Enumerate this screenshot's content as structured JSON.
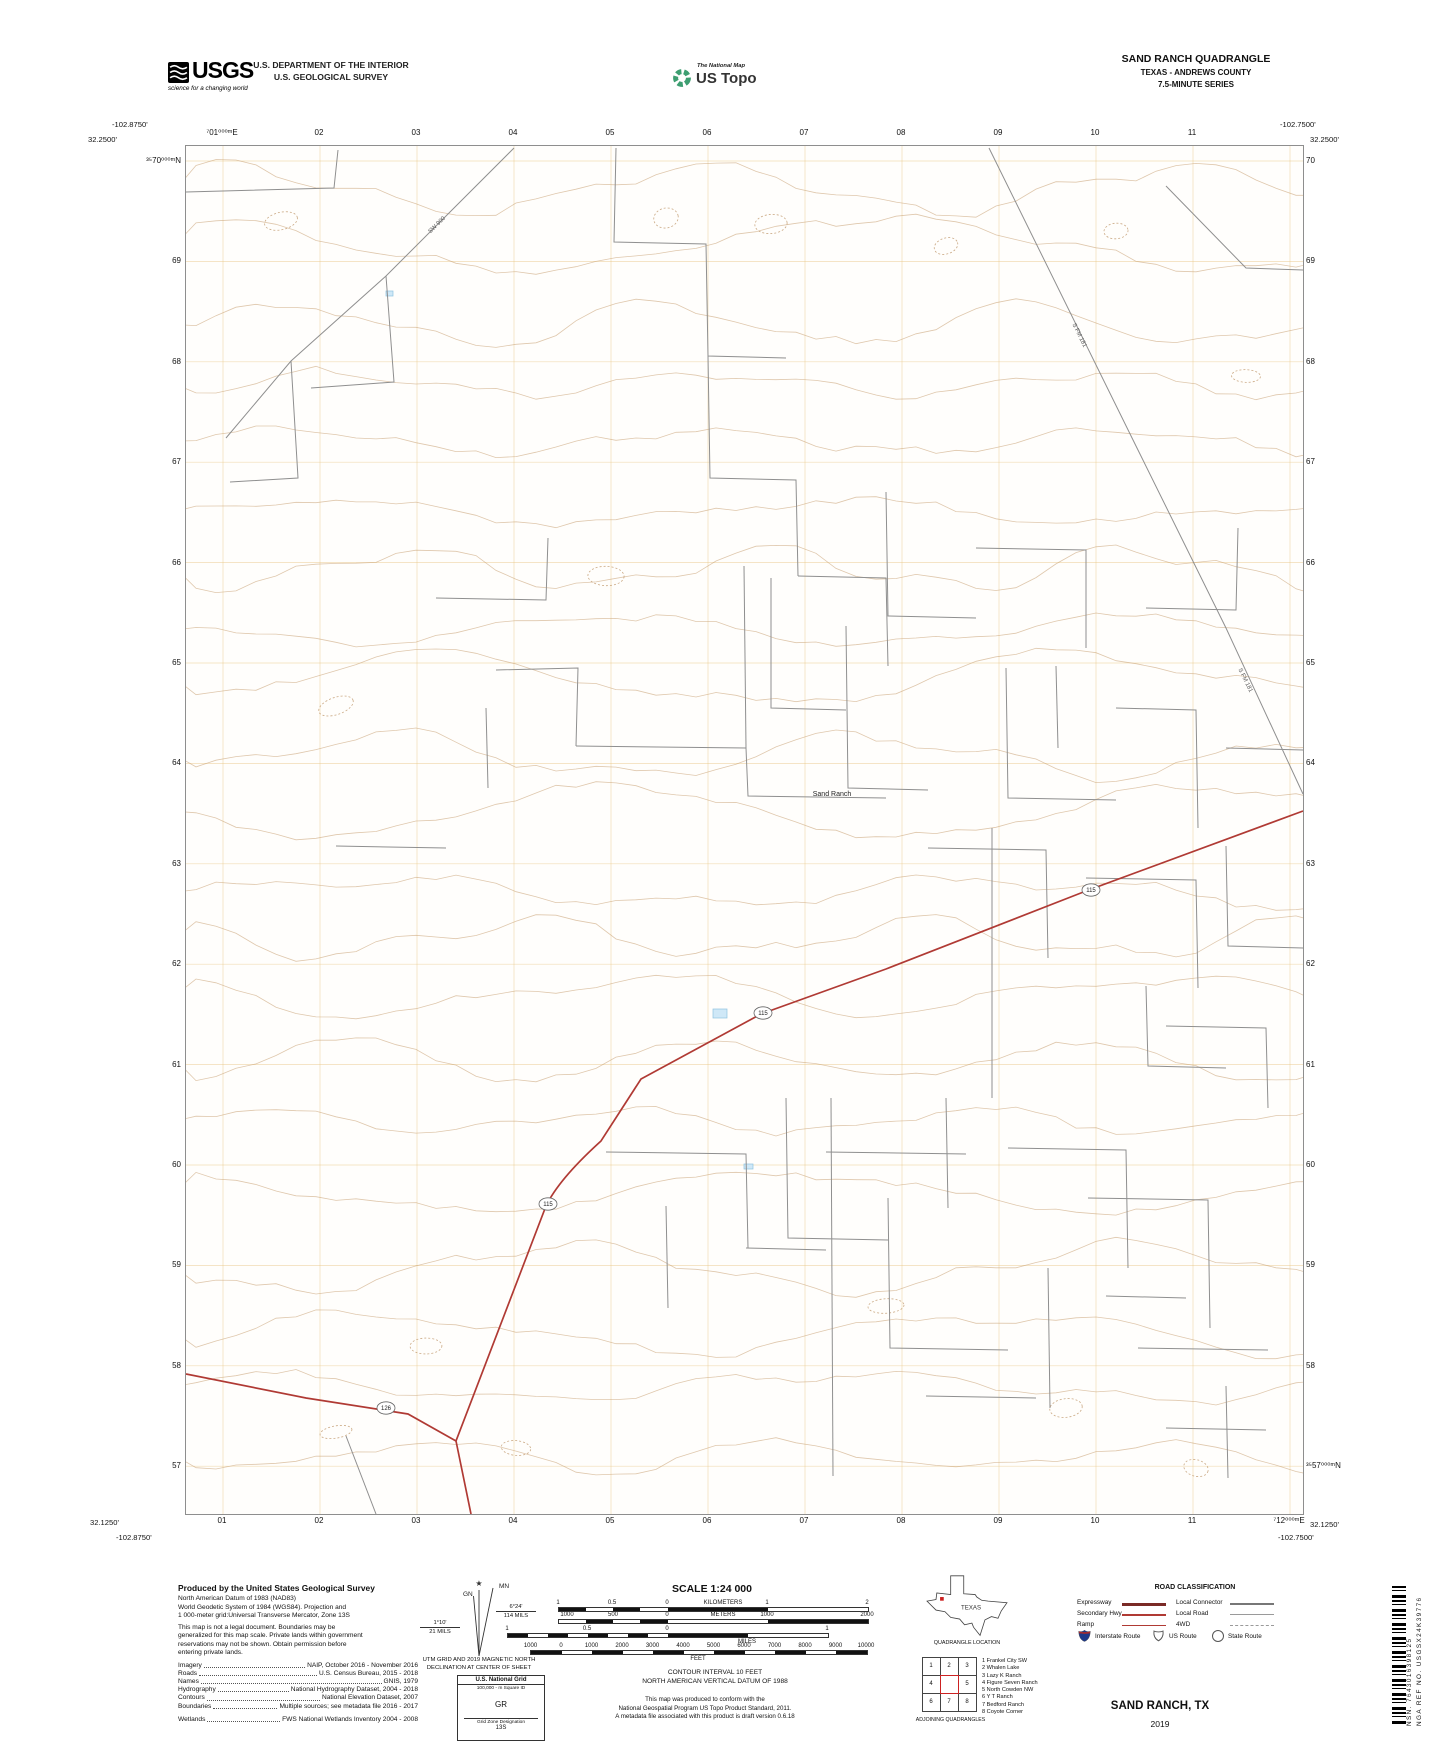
{
  "header": {
    "usgs_logo_text": "USGS",
    "usgs_tagline": "science for a changing world",
    "agency_line1": "U.S. DEPARTMENT OF THE INTERIOR",
    "agency_line2": "U.S. GEOLOGICAL SURVEY",
    "natmap_label": "The National Map",
    "ustopo_label": "US Topo",
    "quad_title": "SAND RANCH QUADRANGLE",
    "quad_subtitle": "TEXAS - ANDREWS COUNTY",
    "quad_series": "7.5-MINUTE SERIES"
  },
  "map": {
    "corners": {
      "top_left_lon": "-102.8750'",
      "top_left_lat": "32.2500'",
      "top_right_lon": "-102.7500'",
      "top_right_lat": "32.2500'",
      "bottom_left_lat": "32.1250'",
      "bottom_left_lon": "-102.8750'",
      "bottom_right_lon": "-102.7500'",
      "bottom_right_lat": "32.1250'"
    },
    "grid_top": [
      "⁷01⁰⁰⁰ᵐE",
      "02",
      "03",
      "04",
      "05",
      "06",
      "07",
      "08",
      "09",
      "10",
      "11"
    ],
    "grid_bottom": [
      "01",
      "02",
      "03",
      "04",
      "05",
      "06",
      "07",
      "08",
      "09",
      "10",
      "11",
      "⁷12⁰⁰⁰ᵐE"
    ],
    "grid_left": [
      "³⁵70⁰⁰⁰ᵐN",
      "69",
      "68",
      "67",
      "66",
      "65",
      "64",
      "63",
      "62",
      "61",
      "60",
      "59",
      "58",
      "57"
    ],
    "grid_right": [
      "70",
      "69",
      "68",
      "67",
      "66",
      "65",
      "64",
      "63",
      "62",
      "61",
      "60",
      "59",
      "58",
      "³⁵57⁰⁰⁰ᵐN"
    ],
    "place_labels": [
      "Sand Ranch",
      "S FM 181",
      "S FM 181",
      "SW 900"
    ],
    "route_shields": [
      "115",
      "115",
      "115",
      "126"
    ]
  },
  "footer": {
    "produced": {
      "title": "Produced by the United States Geological Survey",
      "datum_lines": [
        "North American Datum of 1983 (NAD83)",
        "World Geodetic System of 1984 (WGS84).  Projection and",
        "1 000-meter grid:Universal Transverse Mercator, Zone 13S"
      ],
      "legal_lines": [
        "This map is not a legal document. Boundaries may be",
        "generalized for this map scale. Private lands within government",
        "reservations may not be shown. Obtain permission before",
        "entering private lands."
      ],
      "sources": [
        {
          "label": "Imagery",
          "value": "NAIP, October 2016 - November 2016"
        },
        {
          "label": "Roads",
          "value": "U.S. Census Bureau, 2015 - 2018"
        },
        {
          "label": "Names",
          "value": "GNIS, 1979"
        },
        {
          "label": "Hydrography",
          "value": "National Hydrography Dataset, 2004 - 2018"
        },
        {
          "label": "Contours",
          "value": "National Elevation Dataset, 2007"
        },
        {
          "label": "Boundaries",
          "value": "Multiple sources; see metadata file 2016 - 2017"
        },
        {
          "label": "Wetlands",
          "value": "FWS National Wetlands Inventory 2004 - 2008"
        }
      ]
    },
    "declination": {
      "mn_label": "MN",
      "gn_label": "GN",
      "mn_value": "6°24'",
      "mn_mils": "114 MILS",
      "gn_value": "1°10'",
      "gn_mils": "21 MILS",
      "caption_line1": "UTM GRID AND 2019 MAGNETIC NORTH",
      "caption_line2": "DECLINATION AT CENTER OF SHEET"
    },
    "usng": {
      "title": "U.S. National Grid",
      "subtitle": "100,000 - m Square ID",
      "square_id": "GR",
      "zone_label": "Grid Zone Designation",
      "zone_value": "13S"
    },
    "scale": {
      "title": "SCALE 1:24 000",
      "km": {
        "nums": [
          "1",
          "0.5",
          "0",
          "1",
          "2"
        ],
        "unit": "KILOMETERS"
      },
      "m": {
        "nums": [
          "1000",
          "500",
          "0",
          "1000",
          "2000"
        ],
        "unit": "METERS"
      },
      "mi": {
        "nums": [
          "1",
          "0.5",
          "0",
          "1"
        ],
        "unit": "MILES"
      },
      "ft": {
        "nums": [
          "1000",
          "0",
          "1000",
          "2000",
          "3000",
          "4000",
          "5000",
          "6000",
          "7000",
          "8000",
          "9000",
          "10000"
        ],
        "unit": "FEET"
      }
    },
    "contour_line1": "CONTOUR INTERVAL 10 FEET",
    "contour_line2": "NORTH AMERICAN VERTICAL DATUM OF 1988",
    "conformance_lines": [
      "This map was produced to conform with the",
      "National Geospatial Program US Topo Product Standard, 2011.",
      "A metadata file associated with this product is draft version 0.6.18"
    ],
    "location": {
      "state": "TEXAS",
      "caption": "QUADRANGLE LOCATION"
    },
    "adjoining": {
      "caption": "ADJOINING QUADRANGLES",
      "cells": [
        "1",
        "2",
        "3",
        "4",
        "",
        "5",
        "6",
        "7",
        "8"
      ],
      "names": [
        "1 Frankel City SW",
        "2 Whalen Lake",
        "3 Lazy K Ranch",
        "4 Figure Seven Ranch",
        "5 North Cowden NW",
        "6 Y T Ranch",
        "7 Bedford Ranch",
        "8 Coyote Corner"
      ]
    },
    "road_class": {
      "title": "ROAD CLASSIFICATION",
      "left_labels": [
        "Expressway",
        "Secondary Hwy",
        "Ramp"
      ],
      "right_labels": [
        "Local Connector",
        "Local Road",
        "4WD"
      ],
      "shield_labels": [
        "Interstate Route",
        "US Route",
        "State Route"
      ]
    },
    "sheet_name": "SAND RANCH,  TX",
    "sheet_year": "2019",
    "barcode_nsn": "NSN.  7643016398125",
    "barcode_nga": "NGA REF NO.  USGSX24K39776"
  }
}
